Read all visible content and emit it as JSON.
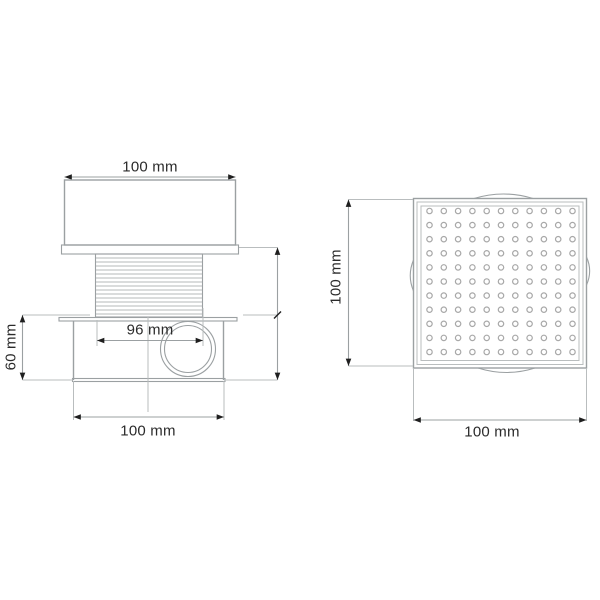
{
  "side_view": {
    "top_width_label": "100 mm",
    "thread_width_label": "96 mm",
    "height_label": "60 mm",
    "bottom_width_label": "100 mm"
  },
  "top_view": {
    "height_label": "100 mm",
    "width_label": "100 mm",
    "grate": {
      "rows": 11,
      "cols": 11
    }
  },
  "colors": {
    "line": "#9ba0a2",
    "text": "#2b2b2b",
    "arrow": "#1f1f1f",
    "hole": "#a8a8a8",
    "thread": "#b4b8ba"
  }
}
